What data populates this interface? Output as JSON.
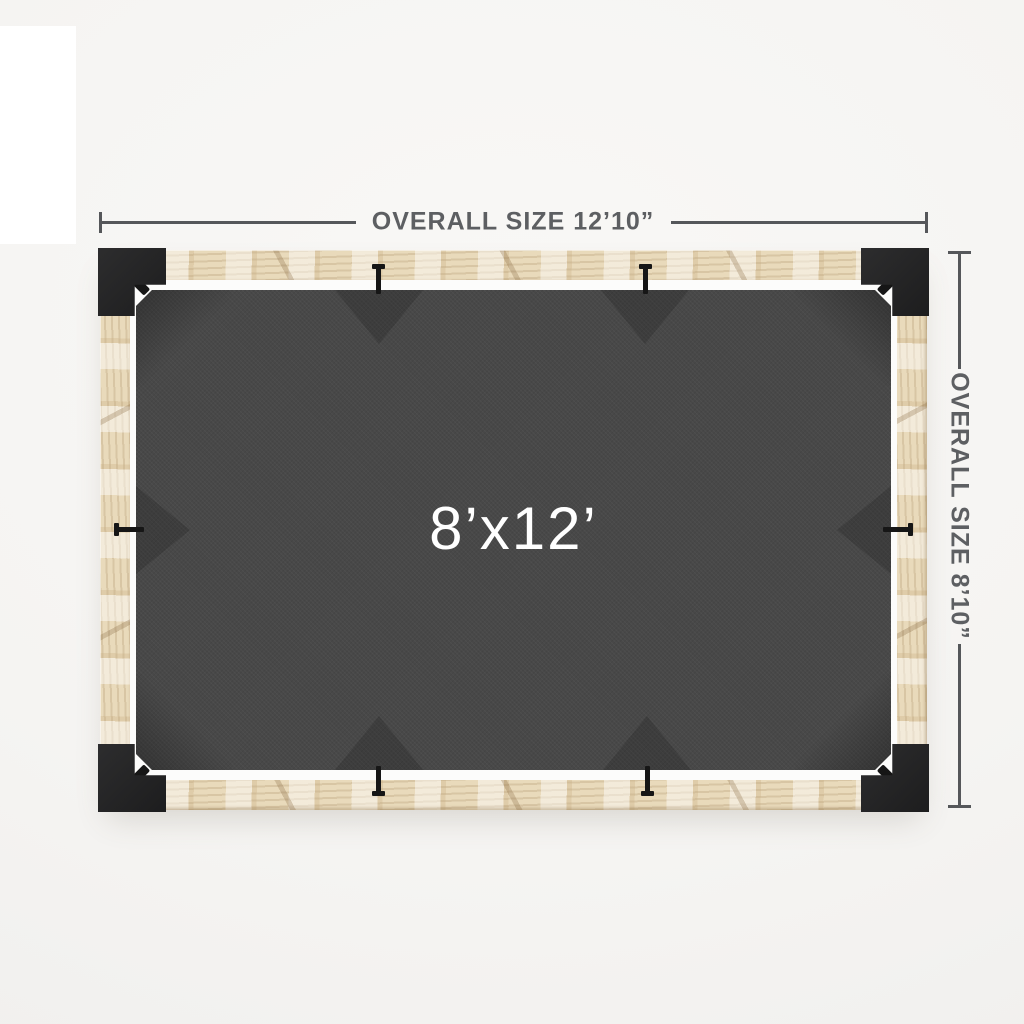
{
  "image": {
    "type": "pergola-top-view-dimension-diagram",
    "background_color": "#f5f4f2"
  },
  "dimensions": {
    "horizontal": {
      "label": "OVERALL SIZE 12’10”"
    },
    "vertical": {
      "label": "OVERALL SIZE 8’10”"
    }
  },
  "canopy": {
    "label": "8’x12’",
    "fabric_color": "#484848",
    "label_color": "#ffffff"
  },
  "frame": {
    "wood_color": "#e9dabb",
    "bracket_color": "#242424",
    "hardware_color": "#161616",
    "inner_gap_color": "#fcfcfb"
  },
  "annotation": {
    "line_color": "#55575a",
    "text_color": "#5d5f62"
  }
}
